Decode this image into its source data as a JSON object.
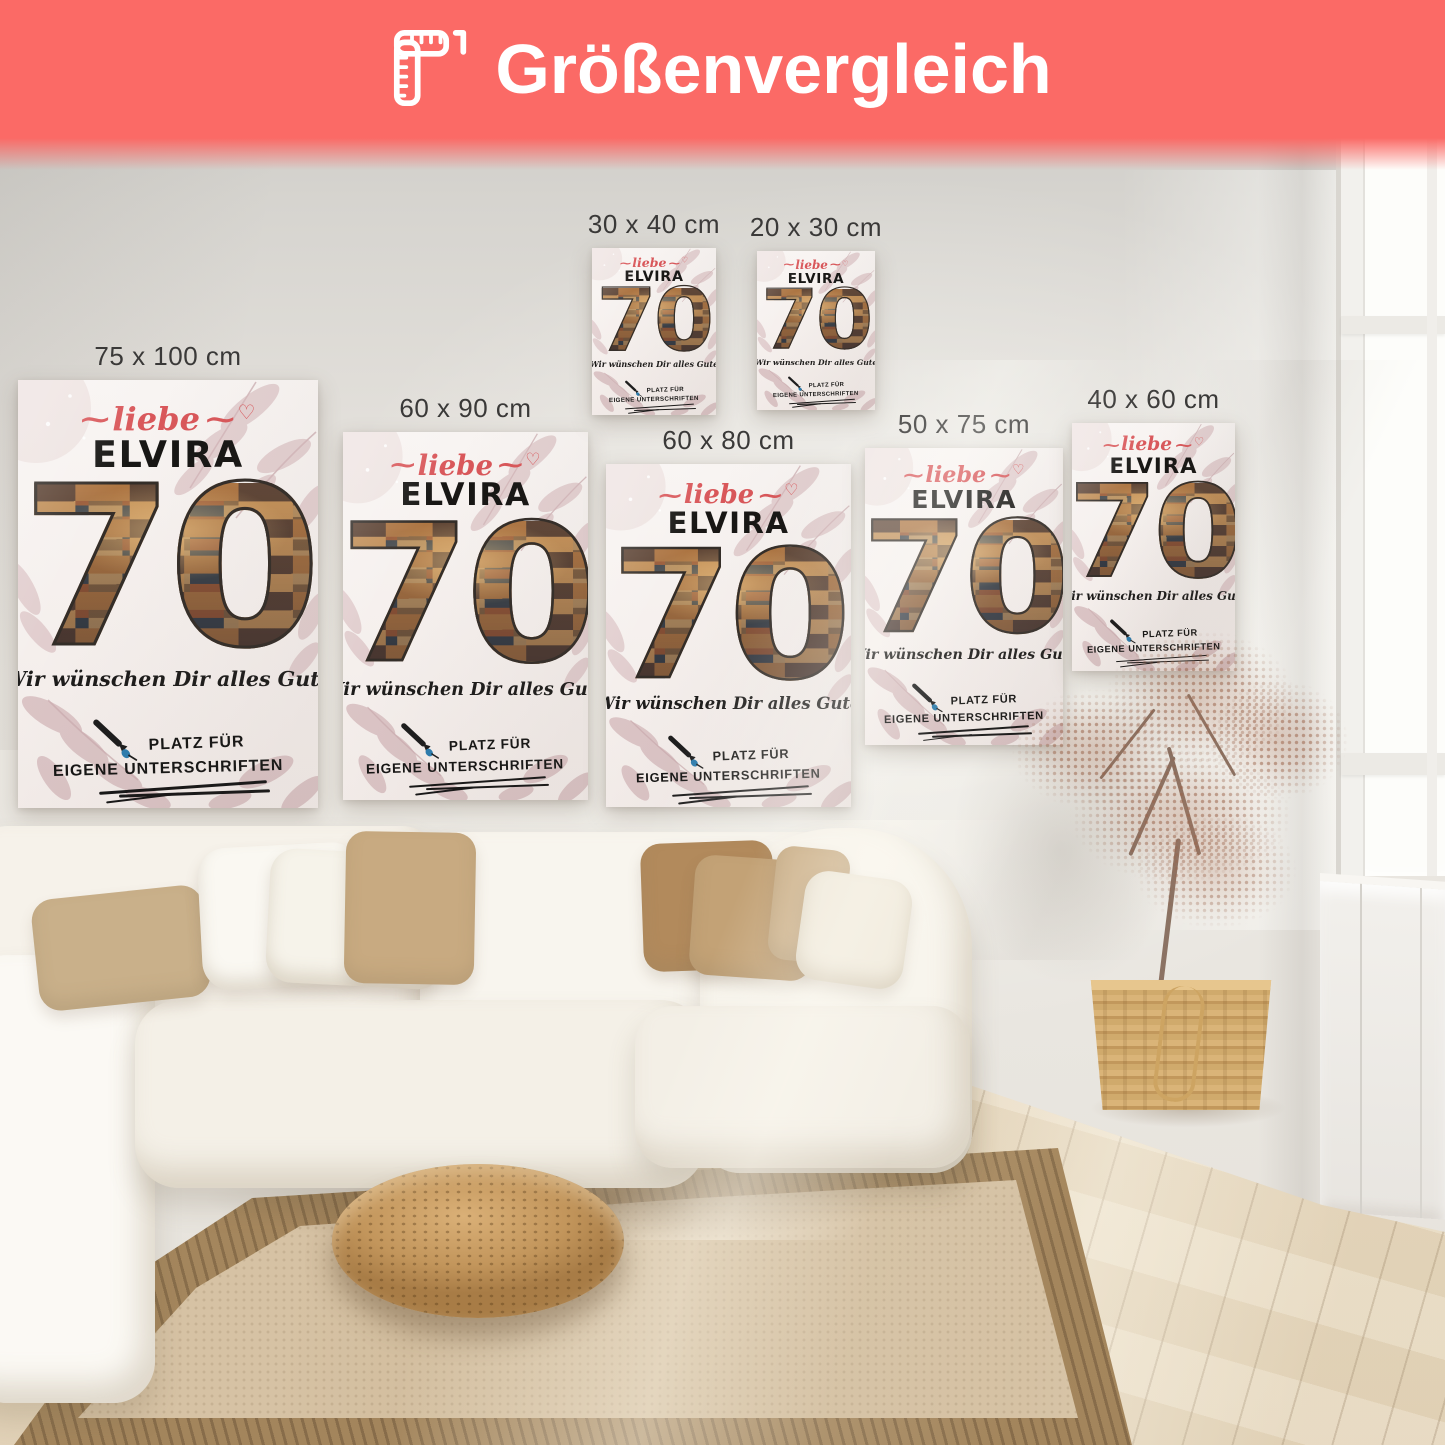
{
  "banner": {
    "title": "Größenvergleich",
    "icon": "ruler-icon",
    "background_color": "#fb6a66",
    "text_color": "#ffffff"
  },
  "poster_design": {
    "greeting": "liebe",
    "greeting_flourish": "⁓",
    "greeting_heart": "♡",
    "name": "ELVIRA",
    "number": "70",
    "message": "Wir wünschen Dir alles Gute",
    "signature_line1": "PLATZ FÜR",
    "signature_line2": "EIGENE UNTERSCHRIFTEN",
    "accent_color": "#d9575a",
    "pen_icon": "fountain-pen-icon"
  },
  "posters": [
    {
      "label": "75 x 100 cm",
      "x": 18,
      "y": 380,
      "w": 300,
      "h": 428
    },
    {
      "label": "60 x 90 cm",
      "x": 343,
      "y": 432,
      "w": 245,
      "h": 368
    },
    {
      "label": "30 x 40 cm",
      "x": 592,
      "y": 248,
      "w": 124,
      "h": 167
    },
    {
      "label": "20 x 30 cm",
      "x": 757,
      "y": 251,
      "w": 118,
      "h": 159
    },
    {
      "label": "60 x 80 cm",
      "x": 606,
      "y": 464,
      "w": 245,
      "h": 343
    },
    {
      "label": "50 x 75 cm",
      "x": 865,
      "y": 448,
      "w": 198,
      "h": 297
    },
    {
      "label": "40 x 60 cm",
      "x": 1072,
      "y": 423,
      "w": 163,
      "h": 248
    }
  ],
  "scene": {
    "label_color": "#3a3938"
  }
}
